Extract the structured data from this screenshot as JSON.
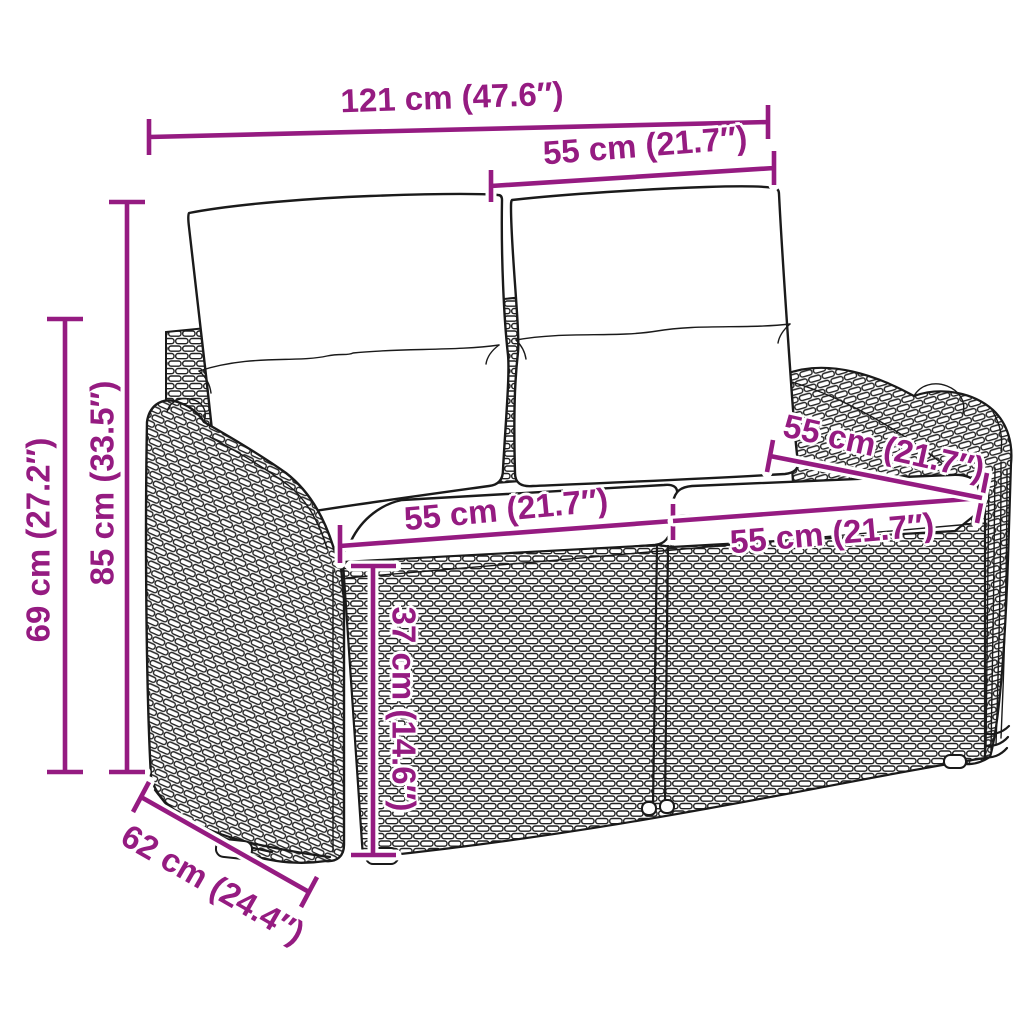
{
  "illustration": {
    "alt": "Line drawing of a two-seat poly rattan garden bench with two back cushions and two seat cushions, annotated with dimensions",
    "modules": 2
  },
  "style": {
    "background": "#ffffff",
    "dimension_color": "#951b81",
    "line_art_color": "#1a1a1a"
  },
  "dimensions": {
    "total_width": {
      "label": "121 cm (47.6″)"
    },
    "backrest_width": {
      "label": "55 cm (21.7″)"
    },
    "total_height": {
      "label": "85 cm (33.5″)"
    },
    "armrest_height": {
      "label": "69 cm (27.2″)"
    },
    "seat_width_left": {
      "label": "55 cm (21.7″)"
    },
    "seat_width_right": {
      "label": "55 cm (21.7″)"
    },
    "seat_depth": {
      "label": "55 cm (21.7″)"
    },
    "seat_height": {
      "label": "37 cm (14.6″)"
    },
    "total_depth": {
      "label": "62 cm (24.4″)"
    }
  }
}
